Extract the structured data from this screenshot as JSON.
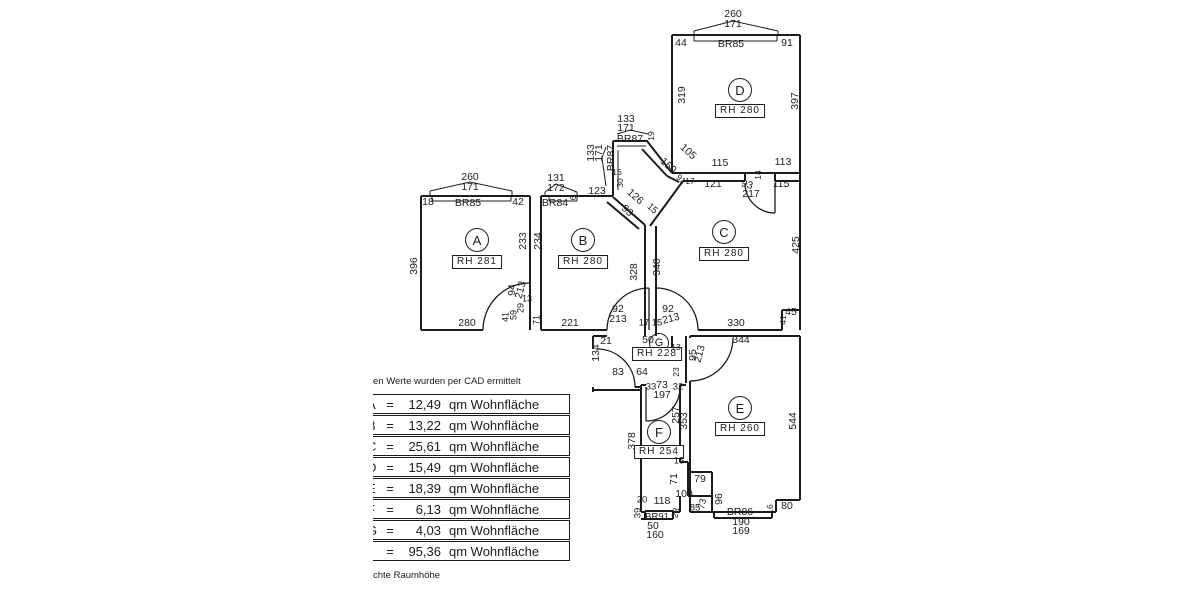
{
  "colors": {
    "ink": "#1c1c1c",
    "background": "#ffffff"
  },
  "notes": {
    "top": "en Werte wurden per CAD ermittelt",
    "bottom": "chte Raumhöhe"
  },
  "table": {
    "eq_sign": "=",
    "unit": "qm Wohnfläche",
    "rows": [
      {
        "letter": "A",
        "value": "12,49"
      },
      {
        "letter": "B",
        "value": "13,22"
      },
      {
        "letter": "C",
        "value": "25,61"
      },
      {
        "letter": "D",
        "value": "15,49"
      },
      {
        "letter": "E",
        "value": "18,39"
      },
      {
        "letter": "F",
        "value": "6,13"
      },
      {
        "letter": "G",
        "value": "4,03"
      },
      {
        "letter": "",
        "value": "95,36"
      }
    ]
  },
  "plan": {
    "rooms": [
      {
        "id": "A",
        "room_height": "RH 281"
      },
      {
        "id": "B",
        "room_height": "RH 280"
      },
      {
        "id": "C",
        "room_height": "RH 280"
      },
      {
        "id": "D",
        "room_height": "RH 280"
      },
      {
        "id": "E",
        "room_height": "RH 260"
      },
      {
        "id": "F",
        "room_height": "RH 254"
      },
      {
        "id": "G",
        "room_height": "RH 228"
      }
    ],
    "labels": [
      {
        "t": "260",
        "x": 733,
        "y": 14
      },
      {
        "t": "171",
        "x": 733,
        "y": 24
      },
      {
        "t": "44",
        "x": 681,
        "y": 43
      },
      {
        "t": "BR85",
        "x": 731,
        "y": 44
      },
      {
        "t": "91",
        "x": 787,
        "y": 43
      },
      {
        "t": "319",
        "x": 682,
        "y": 95,
        "r": -90
      },
      {
        "t": "397",
        "x": 795,
        "y": 101,
        "r": -90
      },
      {
        "t": "D",
        "x": 740,
        "y": 90,
        "k": "room"
      },
      {
        "t": "RH 280",
        "x": 740,
        "y": 111,
        "k": "rh"
      },
      {
        "t": "260",
        "x": 470,
        "y": 177
      },
      {
        "t": "171",
        "x": 470,
        "y": 187
      },
      {
        "t": "18",
        "x": 428,
        "y": 202
      },
      {
        "t": "BR85",
        "x": 468,
        "y": 203
      },
      {
        "t": "42",
        "x": 518,
        "y": 202
      },
      {
        "t": "396",
        "x": 414,
        "y": 266,
        "r": -90
      },
      {
        "t": "A",
        "x": 477,
        "y": 240,
        "k": "room"
      },
      {
        "t": "RH 281",
        "x": 477,
        "y": 262,
        "k": "rh"
      },
      {
        "t": "233",
        "x": 523,
        "y": 241,
        "r": -90
      },
      {
        "t": "234",
        "x": 538,
        "y": 241,
        "r": -90
      },
      {
        "t": "280",
        "x": 467,
        "y": 323
      },
      {
        "t": "94",
        "x": 512,
        "y": 290,
        "r": -90
      },
      {
        "t": "213",
        "x": 521,
        "y": 290,
        "r": -75
      },
      {
        "t": "13",
        "x": 527,
        "y": 299,
        "fs": 9
      },
      {
        "t": "29",
        "x": 521,
        "y": 308,
        "r": -90,
        "fs": 9
      },
      {
        "t": "59",
        "x": 514,
        "y": 315,
        "r": -90,
        "fs": 9
      },
      {
        "t": "41",
        "x": 506,
        "y": 317,
        "r": -90,
        "fs": 9
      },
      {
        "t": "71",
        "x": 537,
        "y": 320,
        "r": -90,
        "fs": 9
      },
      {
        "t": "131",
        "x": 556,
        "y": 178
      },
      {
        "t": "172",
        "x": 556,
        "y": 188
      },
      {
        "t": "BR84",
        "x": 555,
        "y": 203
      },
      {
        "t": "6",
        "x": 574,
        "y": 198,
        "r": -90,
        "fs": 8
      },
      {
        "t": "123",
        "x": 597,
        "y": 191
      },
      {
        "t": "B",
        "x": 583,
        "y": 240,
        "k": "room"
      },
      {
        "t": "RH 280",
        "x": 583,
        "y": 262,
        "k": "rh"
      },
      {
        "t": "328",
        "x": 634,
        "y": 272,
        "r": -90
      },
      {
        "t": "340",
        "x": 657,
        "y": 267,
        "r": -90
      },
      {
        "t": "221",
        "x": 570,
        "y": 323
      },
      {
        "t": "92",
        "x": 618,
        "y": 309
      },
      {
        "t": "213",
        "x": 618,
        "y": 319
      },
      {
        "t": "17",
        "x": 644,
        "y": 323,
        "fs": 9.5
      },
      {
        "t": "15",
        "x": 657,
        "y": 323,
        "fs": 9.5
      },
      {
        "t": "92",
        "x": 668,
        "y": 309
      },
      {
        "t": "213",
        "x": 671,
        "y": 319,
        "r": -15
      },
      {
        "t": "133",
        "x": 626,
        "y": 119
      },
      {
        "t": "171",
        "x": 626,
        "y": 128
      },
      {
        "t": "BR87",
        "x": 630,
        "y": 139
      },
      {
        "t": "19",
        "x": 651,
        "y": 136,
        "r": -90,
        "fs": 8.5
      },
      {
        "t": "133",
        "x": 591,
        "y": 153,
        "r": -90
      },
      {
        "t": "171",
        "x": 599,
        "y": 153,
        "r": -90
      },
      {
        "t": "BR87",
        "x": 611,
        "y": 158,
        "r": -90
      },
      {
        "t": "16",
        "x": 617,
        "y": 172,
        "fs": 8.5
      },
      {
        "t": "30",
        "x": 620,
        "y": 183,
        "r": -90,
        "fs": 8.5
      },
      {
        "t": "126",
        "x": 635,
        "y": 197,
        "r": 42
      },
      {
        "t": "93",
        "x": 627,
        "y": 211,
        "r": 42
      },
      {
        "t": "15",
        "x": 652,
        "y": 209,
        "r": 42,
        "fs": 9.5
      },
      {
        "t": "105",
        "x": 688,
        "y": 152,
        "r": 42
      },
      {
        "t": "150",
        "x": 668,
        "y": 166,
        "r": 42
      },
      {
        "t": "91",
        "x": 681,
        "y": 179,
        "r": 42,
        "fs": 8.5
      },
      {
        "t": "17",
        "x": 690,
        "y": 181,
        "fs": 8.5
      },
      {
        "t": "115",
        "x": 720,
        "y": 163
      },
      {
        "t": "113",
        "x": 783,
        "y": 162
      },
      {
        "t": "121",
        "x": 713,
        "y": 184
      },
      {
        "t": "115",
        "x": 781,
        "y": 184
      },
      {
        "t": "93",
        "x": 747,
        "y": 185,
        "r": 15
      },
      {
        "t": "217",
        "x": 751,
        "y": 194
      },
      {
        "t": "14",
        "x": 758,
        "y": 175,
        "r": -90,
        "fs": 8.5
      },
      {
        "t": "C",
        "x": 724,
        "y": 232,
        "k": "room"
      },
      {
        "t": "RH 280",
        "x": 724,
        "y": 254,
        "k": "rh"
      },
      {
        "t": "425",
        "x": 796,
        "y": 245,
        "r": -90
      },
      {
        "t": "330",
        "x": 736,
        "y": 323
      },
      {
        "t": "45",
        "x": 791,
        "y": 312
      },
      {
        "t": "41",
        "x": 783,
        "y": 320,
        "r": -90,
        "fs": 8.5
      },
      {
        "t": "21",
        "x": 606,
        "y": 341
      },
      {
        "t": "50",
        "x": 648,
        "y": 340
      },
      {
        "t": "G",
        "x": 659,
        "y": 343,
        "k": "room",
        "s": 18
      },
      {
        "t": "RH 228",
        "x": 657,
        "y": 354,
        "k": "rh"
      },
      {
        "t": "134",
        "x": 596,
        "y": 353,
        "r": -90
      },
      {
        "t": "83",
        "x": 618,
        "y": 372
      },
      {
        "t": "64",
        "x": 642,
        "y": 372
      },
      {
        "t": "33",
        "x": 651,
        "y": 387,
        "fs": 9.5
      },
      {
        "t": "73",
        "x": 662,
        "y": 385
      },
      {
        "t": "197",
        "x": 662,
        "y": 395
      },
      {
        "t": "32",
        "x": 678,
        "y": 387,
        "fs": 9.5
      },
      {
        "t": "13",
        "x": 676,
        "y": 347,
        "fs": 8.5
      },
      {
        "t": "95",
        "x": 693,
        "y": 355,
        "r": -90
      },
      {
        "t": "213",
        "x": 700,
        "y": 354,
        "r": -75
      },
      {
        "t": "23",
        "x": 676,
        "y": 372,
        "r": -90,
        "fs": 8.5
      },
      {
        "t": "344",
        "x": 741,
        "y": 340
      },
      {
        "t": "E",
        "x": 740,
        "y": 408,
        "k": "room"
      },
      {
        "t": "RH 260",
        "x": 740,
        "y": 429,
        "k": "rh"
      },
      {
        "t": "353",
        "x": 684,
        "y": 421,
        "r": -90
      },
      {
        "t": "544",
        "x": 793,
        "y": 421,
        "r": -90
      },
      {
        "t": "F",
        "x": 659,
        "y": 432,
        "k": "room"
      },
      {
        "t": "RH 254",
        "x": 659,
        "y": 452,
        "k": "rh"
      },
      {
        "t": "378",
        "x": 632,
        "y": 441,
        "r": -90
      },
      {
        "t": "257",
        "x": 676,
        "y": 415,
        "r": -90
      },
      {
        "t": "15",
        "x": 679,
        "y": 461,
        "fs": 9.5
      },
      {
        "t": "71",
        "x": 674,
        "y": 479,
        "r": -90
      },
      {
        "t": "79",
        "x": 700,
        "y": 479
      },
      {
        "t": "100",
        "x": 684,
        "y": 494
      },
      {
        "t": "85",
        "x": 695,
        "y": 508,
        "fs": 9.5
      },
      {
        "t": "73",
        "x": 703,
        "y": 504,
        "r": -75,
        "fs": 9.5
      },
      {
        "t": "96",
        "x": 719,
        "y": 499,
        "r": -90
      },
      {
        "t": "20",
        "x": 642,
        "y": 500,
        "fs": 9.5
      },
      {
        "t": "118",
        "x": 662,
        "y": 501
      },
      {
        "t": "39",
        "x": 638,
        "y": 513,
        "r": -90,
        "fs": 9.5
      },
      {
        "t": "BR91",
        "x": 657,
        "y": 517,
        "fs": 9.5
      },
      {
        "t": "23",
        "x": 676,
        "y": 513,
        "r": -75,
        "fs": 9
      },
      {
        "t": "50",
        "x": 653,
        "y": 526
      },
      {
        "t": "160",
        "x": 655,
        "y": 535
      },
      {
        "t": "BR86",
        "x": 740,
        "y": 512
      },
      {
        "t": "16",
        "x": 770,
        "y": 509,
        "r": -90,
        "fs": 8.5
      },
      {
        "t": "80",
        "x": 787,
        "y": 506
      },
      {
        "t": "190",
        "x": 741,
        "y": 522
      },
      {
        "t": "169",
        "x": 741,
        "y": 531
      }
    ]
  }
}
